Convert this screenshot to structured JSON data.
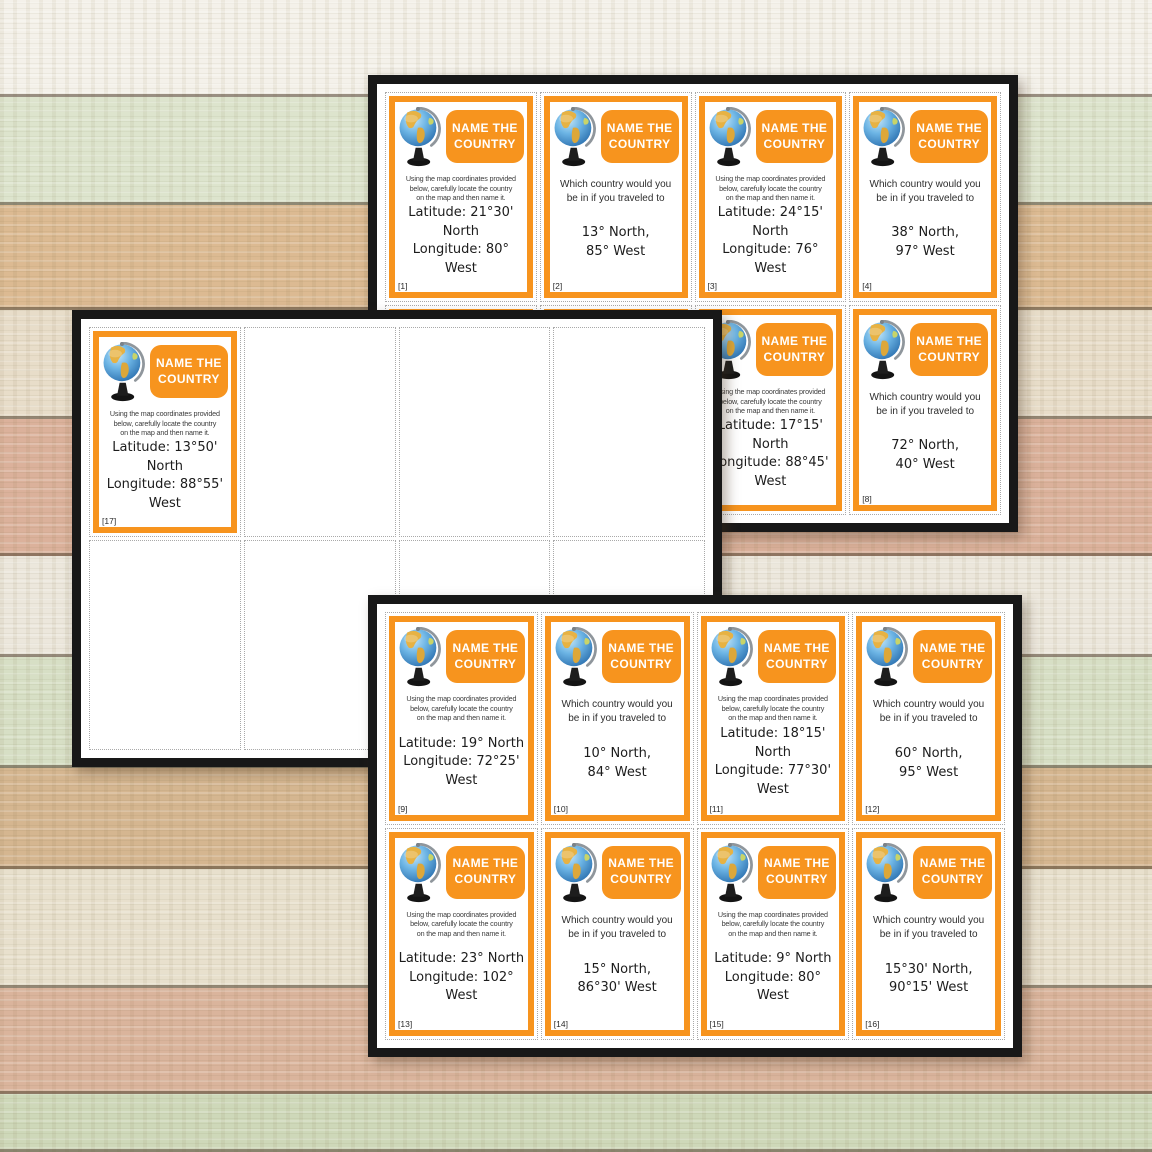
{
  "theme": {
    "orange": "#F7941E",
    "sheet_border": "#181818",
    "sheet_background": "#FFFFFF",
    "cell_border": "#A9A9A9",
    "title_text_color": "#FFFFFF",
    "body_text_color": "#1C1C1C",
    "planks": [
      {
        "h": 97,
        "c": "#f4f1ea"
      },
      {
        "h": 108,
        "c": "#dde4cd"
      },
      {
        "h": 105,
        "c": "#dcba92"
      },
      {
        "h": 109,
        "c": "#e8ddc9"
      },
      {
        "h": 137,
        "c": "#dbb19b"
      },
      {
        "h": 101,
        "c": "#ece7dc"
      },
      {
        "h": 111,
        "c": "#d7dfc5"
      },
      {
        "h": 101,
        "c": "#d5b690"
      },
      {
        "h": 119,
        "c": "#e8e0cd"
      },
      {
        "h": 106,
        "c": "#dab49c"
      },
      {
        "h": 58,
        "c": "#ced8b9"
      }
    ]
  },
  "card_template": {
    "title": "NAME THE COUNTRY",
    "globe_icon": "globe-on-stand-icon",
    "instruction_locate_lines": [
      "Using the map coordinates provided",
      "below, carefully locate the country",
      "on the map and then name it."
    ],
    "instruction_travel_lines": [
      "Which country would you",
      "be in if you traveled to"
    ]
  },
  "sheets": [
    {
      "name": "sheet-top",
      "cards": [
        {
          "number": "[1]",
          "type": "locate",
          "lines": [
            "Latitude: 21°30'",
            "North",
            "Longitude: 80° West"
          ]
        },
        {
          "number": "[2]",
          "type": "travel",
          "lines": [
            "13° North,",
            "85° West"
          ]
        },
        {
          "number": "[3]",
          "type": "locate",
          "lines": [
            "Latitude: 24°15'",
            "North",
            "Longitude: 76° West"
          ]
        },
        {
          "number": "[4]",
          "type": "travel",
          "lines": [
            "38° North,",
            "97° West"
          ]
        },
        {
          "number": "",
          "type": "locate",
          "lines": [],
          "occluded": true
        },
        {
          "number": "",
          "type": "travel",
          "lines": [],
          "occluded": true
        },
        {
          "number": "[7]",
          "type": "locate",
          "lines": [
            "Latitude: 17°15'",
            "North",
            "Longitude: 88°45'",
            "West"
          ]
        },
        {
          "number": "[8]",
          "type": "travel",
          "lines": [
            "72° North,",
            "40° West"
          ]
        }
      ]
    },
    {
      "name": "sheet-middle",
      "cards": [
        {
          "number": "[17]",
          "type": "locate",
          "lines": [
            "Latitude: 13°50'",
            "North",
            "Longitude: 88°55'",
            "West"
          ]
        },
        null,
        null,
        null,
        null,
        null,
        null,
        null
      ]
    },
    {
      "name": "sheet-bottom",
      "cards": [
        {
          "number": "[9]",
          "type": "locate",
          "lines": [
            "Latitude: 19° North",
            "Longitude: 72°25'",
            "West"
          ]
        },
        {
          "number": "[10]",
          "type": "travel",
          "lines": [
            "10° North,",
            "84° West"
          ]
        },
        {
          "number": "[11]",
          "type": "locate",
          "lines": [
            "Latitude: 18°15'",
            "North",
            "Longitude: 77°30'",
            "West"
          ]
        },
        {
          "number": "[12]",
          "type": "travel",
          "lines": [
            "60° North,",
            "95° West"
          ]
        },
        {
          "number": "[13]",
          "type": "locate",
          "lines": [
            "Latitude: 23° North",
            "Longitude: 102°",
            "West"
          ]
        },
        {
          "number": "[14]",
          "type": "travel",
          "lines": [
            "15° North,",
            "86°30' West"
          ]
        },
        {
          "number": "[15]",
          "type": "locate",
          "lines": [
            "Latitude: 9° North",
            "Longitude: 80° West"
          ]
        },
        {
          "number": "[16]",
          "type": "travel",
          "lines": [
            "15°30' North,",
            "90°15' West"
          ]
        }
      ]
    }
  ]
}
